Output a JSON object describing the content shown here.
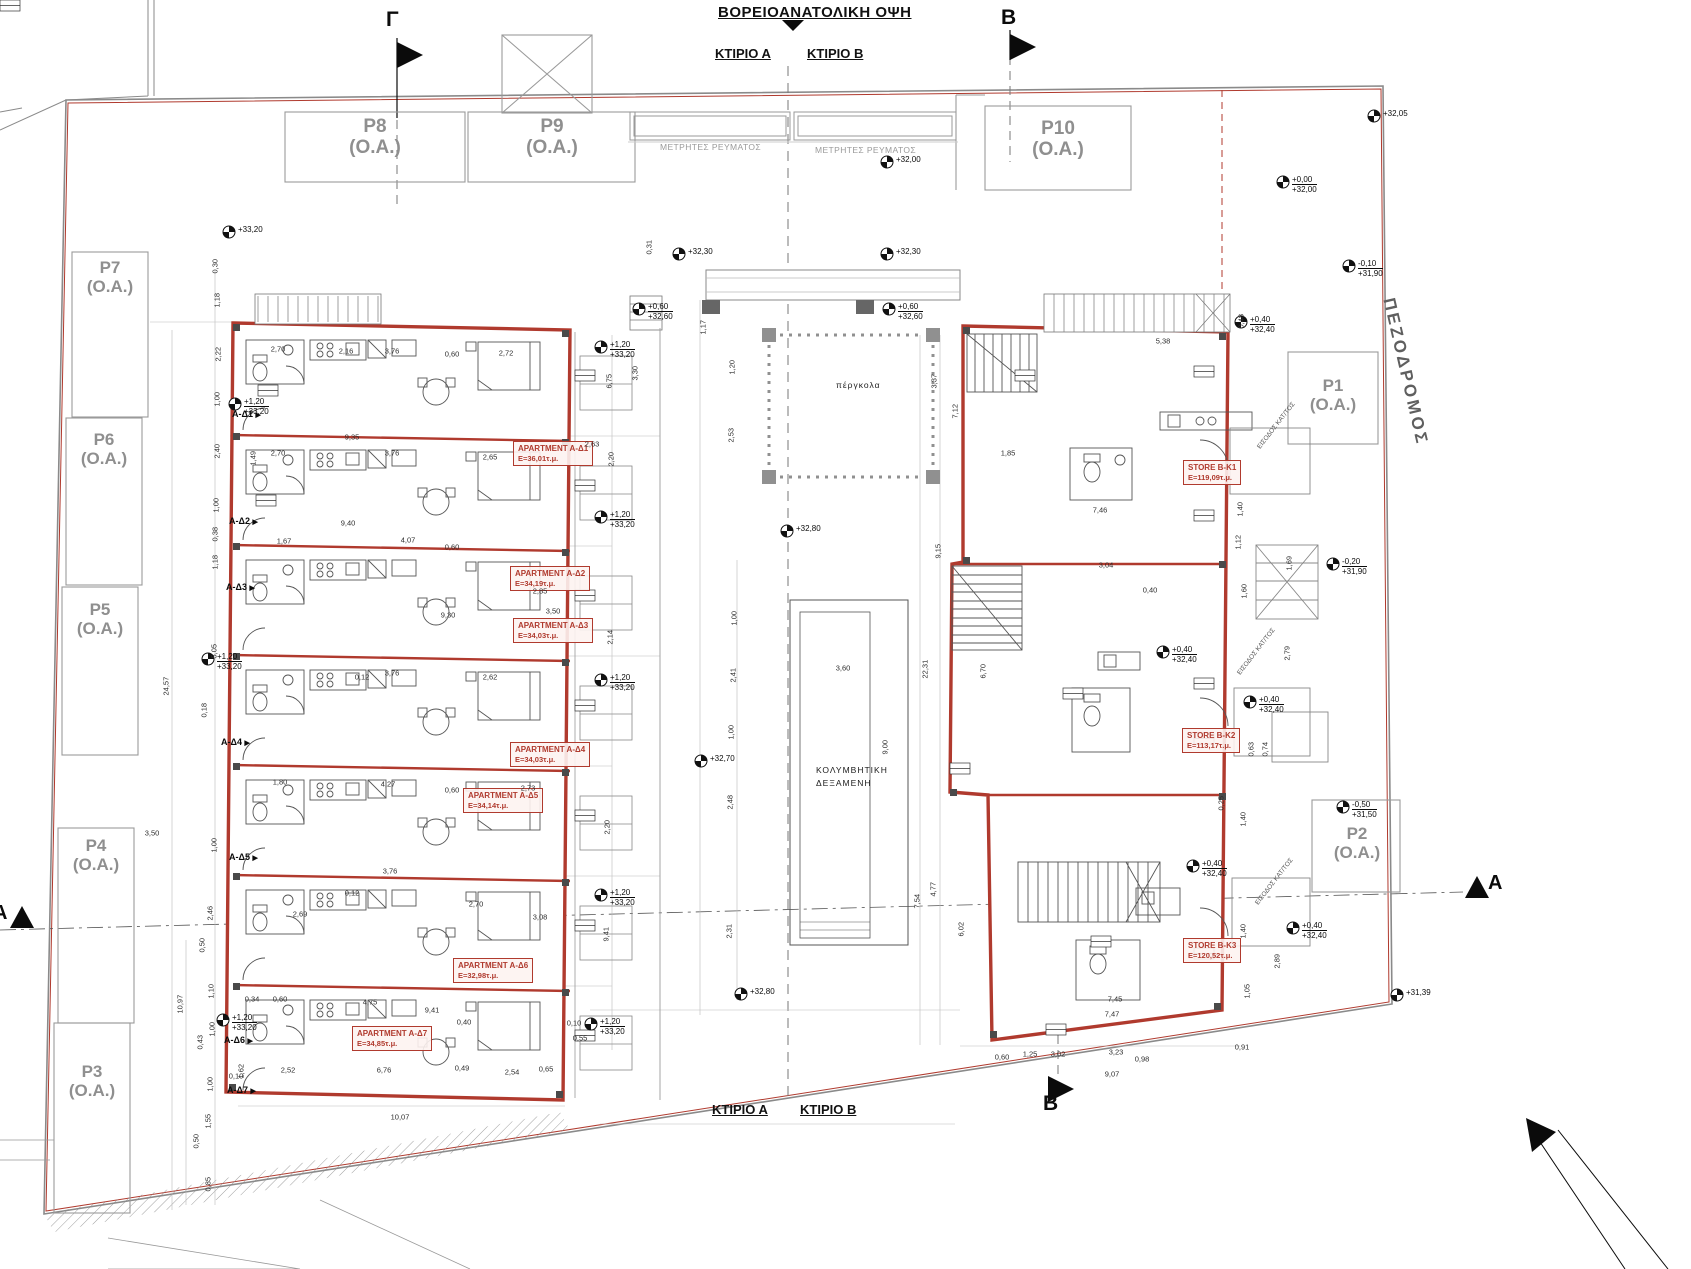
{
  "header": {
    "view_title": "ΒΟΡΕΙΟΑΝΑΤΟΛΙΚΗ ΟΨΗ",
    "building_a": "ΚΤΙΡΙΟ Α",
    "building_b": "ΚΤΙΡΙΟ Β"
  },
  "footer": {
    "building_a": "ΚΤΙΡΙΟ Α",
    "building_b": "ΚΤΙΡΙΟ Β"
  },
  "street": {
    "name": "ΠΕΖΟΔΡΟΜΟΣ"
  },
  "pergola": {
    "label": "πέργκολα"
  },
  "pool": {
    "line1": "ΚΟΛΥΜΒΗΤΙΚΗ",
    "line2": "ΔΕΞΑΜΕΝΗ"
  },
  "meters": {
    "label": "ΜΕΤΡΗΤΕΣ ΡΕΥΜΑΤΟΣ"
  },
  "colors": {
    "accent_red": "#b03a2e",
    "line_dark": "#3a3a3a",
    "line_light": "#999999",
    "text_gray": "#8f8f8f"
  },
  "section_markers": [
    {
      "label": "Γ",
      "x": 386,
      "y": 8,
      "size": 21
    },
    {
      "label": "Β",
      "x": 1001,
      "y": 6,
      "size": 21
    },
    {
      "label": "Β",
      "x": 1043,
      "y": 1092,
      "size": 21
    },
    {
      "label": "Α",
      "x": 1488,
      "y": 872,
      "size": 20
    },
    {
      "label": "Α",
      "x": -7,
      "y": 902,
      "size": 20
    }
  ],
  "parking": [
    {
      "id": "P8",
      "sub": "(Ο.Α.)",
      "x": 375,
      "y": 116,
      "fs": 19
    },
    {
      "id": "P9",
      "sub": "(Ο.Α.)",
      "x": 552,
      "y": 116,
      "fs": 19
    },
    {
      "id": "P10",
      "sub": "(Ο.Α.)",
      "x": 1058,
      "y": 118,
      "fs": 19
    },
    {
      "id": "P7",
      "sub": "(Ο.Α.)",
      "x": 110,
      "y": 258,
      "fs": 17
    },
    {
      "id": "P6",
      "sub": "(Ο.Α.)",
      "x": 104,
      "y": 430,
      "fs": 17
    },
    {
      "id": "P5",
      "sub": "(Ο.Α.)",
      "x": 100,
      "y": 600,
      "fs": 17
    },
    {
      "id": "P4",
      "sub": "(Ο.Α.)",
      "x": 96,
      "y": 836,
      "fs": 17
    },
    {
      "id": "P3",
      "sub": "(Ο.Α.)",
      "x": 92,
      "y": 1062,
      "fs": 17
    },
    {
      "id": "P1",
      "sub": "(Ο.Α.)",
      "x": 1333,
      "y": 376,
      "fs": 17
    },
    {
      "id": "P2",
      "sub": "(Ο.Α.)",
      "x": 1357,
      "y": 824,
      "fs": 17
    }
  ],
  "apartments": [
    {
      "name": "APARTMENT A-Δ1",
      "area": "E=36,01τ.μ.",
      "x": 513,
      "y": 441
    },
    {
      "name": "APARTMENT A-Δ2",
      "area": "E=34,19τ.μ.",
      "x": 510,
      "y": 566
    },
    {
      "name": "APARTMENT A-Δ3",
      "area": "E=34,03τ.μ.",
      "x": 513,
      "y": 618
    },
    {
      "name": "APARTMENT A-Δ4",
      "area": "E=34,03τ.μ.",
      "x": 510,
      "y": 742
    },
    {
      "name": "APARTMENT A-Δ5",
      "area": "E=34,14τ.μ.",
      "x": 463,
      "y": 788
    },
    {
      "name": "APARTMENT A-Δ6",
      "area": "E=32,98τ.μ.",
      "x": 453,
      "y": 958
    },
    {
      "name": "APARTMENT A-Δ7",
      "area": "E=34,85τ.μ.",
      "x": 352,
      "y": 1026
    }
  ],
  "stores": [
    {
      "name": "STORE  B-K1",
      "area": "E=119,09τ.μ.",
      "x": 1183,
      "y": 460
    },
    {
      "name": "STORE  B-K2",
      "area": "E=113,17τ.μ.",
      "x": 1182,
      "y": 728
    },
    {
      "name": "STORE  B-K3",
      "area": "E=120,52τ.μ.",
      "x": 1183,
      "y": 938
    }
  ],
  "unit_tags": [
    {
      "label": "Α-Δ1",
      "x": 232,
      "y": 409
    },
    {
      "label": "Α-Δ2",
      "x": 229,
      "y": 516
    },
    {
      "label": "Α-Δ3",
      "x": 226,
      "y": 582
    },
    {
      "label": "Α-Δ4",
      "x": 221,
      "y": 737
    },
    {
      "label": "Α-Δ5",
      "x": 229,
      "y": 852
    },
    {
      "label": "Α-Δ6",
      "x": 224,
      "y": 1035
    },
    {
      "label": "Α-Δ7",
      "x": 227,
      "y": 1085
    }
  ],
  "entrance_labels": [
    {
      "text": "ΕΙΣΟΔΟΣ ΚΑΤ/ΤΟΣ",
      "x": 1256,
      "y": 446,
      "r": -52
    },
    {
      "text": "ΕΙΣΟΔΟΣ ΚΑΤ/ΤΟΣ",
      "x": 1236,
      "y": 672,
      "r": -52
    },
    {
      "text": "ΕΙΣΟΔΟΣ ΚΑΤ/ΤΟΣ",
      "x": 1254,
      "y": 902,
      "r": -52
    }
  ],
  "elevations": [
    {
      "lines": [
        "+32,05"
      ],
      "x": 1385,
      "y": 112
    },
    {
      "lines": [
        "+32,00"
      ],
      "x": 898,
      "y": 158
    },
    {
      "lines": [
        "+0,00",
        "+32,00"
      ],
      "x": 1294,
      "y": 178
    },
    {
      "lines": [
        "+32,30"
      ],
      "x": 690,
      "y": 250
    },
    {
      "lines": [
        "+32,30"
      ],
      "x": 898,
      "y": 250
    },
    {
      "lines": [
        "-0,10",
        "+31,90"
      ],
      "x": 1360,
      "y": 262
    },
    {
      "lines": [
        "+0,60",
        "+32,60"
      ],
      "x": 650,
      "y": 305
    },
    {
      "lines": [
        "+0,60",
        "+32,60"
      ],
      "x": 900,
      "y": 305
    },
    {
      "lines": [
        "+0,40",
        "+32,40"
      ],
      "x": 1252,
      "y": 318
    },
    {
      "lines": [
        "+33,20"
      ],
      "x": 240,
      "y": 228
    },
    {
      "lines": [
        "+1,20",
        "+33,20"
      ],
      "x": 246,
      "y": 400
    },
    {
      "lines": [
        "+1,20",
        "+33,20"
      ],
      "x": 612,
      "y": 343
    },
    {
      "lines": [
        "+1,20",
        "+33,20"
      ],
      "x": 612,
      "y": 513
    },
    {
      "lines": [
        "+32,80"
      ],
      "x": 798,
      "y": 527
    },
    {
      "lines": [
        "-0,20",
        "+31,90"
      ],
      "x": 1344,
      "y": 560
    },
    {
      "lines": [
        "+1,20",
        "+33,20"
      ],
      "x": 219,
      "y": 655
    },
    {
      "lines": [
        "+1,20",
        "+33,20"
      ],
      "x": 612,
      "y": 676
    },
    {
      "lines": [
        "+0,40",
        "+32,40"
      ],
      "x": 1174,
      "y": 648
    },
    {
      "lines": [
        "+0,40",
        "+32,40"
      ],
      "x": 1261,
      "y": 698
    },
    {
      "lines": [
        "+32,70"
      ],
      "x": 712,
      "y": 757
    },
    {
      "lines": [
        "-0,50",
        "+31,50"
      ],
      "x": 1354,
      "y": 803
    },
    {
      "lines": [
        "+0,40",
        "+32,40"
      ],
      "x": 1204,
      "y": 862
    },
    {
      "lines": [
        "+1,20",
        "+33,20"
      ],
      "x": 612,
      "y": 891
    },
    {
      "lines": [
        "+0,40",
        "+32,40"
      ],
      "x": 1304,
      "y": 924
    },
    {
      "lines": [
        "+1,20",
        "+33,20"
      ],
      "x": 234,
      "y": 1016
    },
    {
      "lines": [
        "+32,80"
      ],
      "x": 752,
      "y": 990
    },
    {
      "lines": [
        "+31,39"
      ],
      "x": 1408,
      "y": 991
    },
    {
      "lines": [
        "+1,20",
        "+33,20"
      ],
      "x": 602,
      "y": 1020
    }
  ],
  "dimensions": [
    [
      "0,30",
      218,
      278,
      -90
    ],
    [
      "1,18",
      220,
      312,
      -90
    ],
    [
      "2,22",
      221,
      366,
      -90
    ],
    [
      "1,00",
      220,
      411,
      -90
    ],
    [
      "2,40",
      220,
      463,
      -90
    ],
    [
      "1,00",
      219,
      517,
      -90
    ],
    [
      "0,38",
      218,
      546,
      -90
    ],
    [
      "1,18",
      218,
      574,
      -90
    ],
    [
      "5,05",
      217,
      663,
      -90
    ],
    [
      "24,57",
      171,
      700,
      -90
    ],
    [
      "0,18",
      207,
      722,
      -90
    ],
    [
      "3,50",
      152,
      833,
      0
    ],
    [
      "1,00",
      217,
      857,
      -90
    ],
    [
      "2,46",
      213,
      925,
      -90
    ],
    [
      "0,50",
      205,
      957,
      -90
    ],
    [
      "1,10",
      214,
      1003,
      -90
    ],
    [
      "10,97",
      185,
      1018,
      -90
    ],
    [
      "1,00",
      215,
      1041,
      -90
    ],
    [
      "0,43",
      203,
      1054,
      -90
    ],
    [
      "0,10",
      236,
      1076,
      0
    ],
    [
      "1,00",
      213,
      1096,
      -90
    ],
    [
      "1,55",
      211,
      1133,
      -90
    ],
    [
      "0,50",
      199,
      1153,
      -90
    ],
    [
      "0,85",
      211,
      1196,
      -90
    ],
    [
      "2,70",
      278,
      349,
      0
    ],
    [
      "2,16",
      346,
      351,
      0
    ],
    [
      "3,76",
      392,
      351,
      0
    ],
    [
      "0,60",
      452,
      354,
      0
    ],
    [
      "2,72",
      506,
      353,
      0
    ],
    [
      "9,35",
      352,
      437,
      0
    ],
    [
      "1,49",
      256,
      470,
      -90
    ],
    [
      "2,70",
      278,
      453,
      0
    ],
    [
      "3,76",
      392,
      453,
      0
    ],
    [
      "2,65",
      490,
      457,
      0
    ],
    [
      "9,40",
      348,
      523,
      0
    ],
    [
      "1,67",
      284,
      541,
      0
    ],
    [
      "4,07",
      408,
      540,
      0
    ],
    [
      "0,60",
      452,
      547,
      0
    ],
    [
      "2,85",
      540,
      591,
      0
    ],
    [
      "9,30",
      448,
      615,
      0
    ],
    [
      "3,50",
      553,
      611,
      0
    ],
    [
      "2,63",
      592,
      444,
      0
    ],
    [
      "0,12",
      362,
      677,
      0
    ],
    [
      "3,76",
      392,
      673,
      0
    ],
    [
      "2,62",
      490,
      677,
      0
    ],
    [
      "1,80",
      280,
      782,
      0
    ],
    [
      "4,27",
      388,
      784,
      0
    ],
    [
      "2,73",
      528,
      788,
      0
    ],
    [
      "0,60",
      452,
      790,
      0
    ],
    [
      "3,76",
      390,
      871,
      0
    ],
    [
      "0,12",
      352,
      893,
      0
    ],
    [
      "2,69",
      300,
      914,
      0
    ],
    [
      "2,70",
      476,
      904,
      0
    ],
    [
      "3,08",
      540,
      917,
      0
    ],
    [
      "0,34",
      252,
      999,
      0
    ],
    [
      "0,60",
      280,
      999,
      0
    ],
    [
      "4,75",
      370,
      1002,
      0
    ],
    [
      "9,41",
      432,
      1010,
      0
    ],
    [
      "0,40",
      464,
      1022,
      0
    ],
    [
      "2,52",
      288,
      1070,
      0
    ],
    [
      "6,76",
      384,
      1070,
      0
    ],
    [
      "0,49",
      462,
      1068,
      0
    ],
    [
      "2,54",
      512,
      1072,
      0
    ],
    [
      "1,62",
      244,
      1083,
      -90
    ],
    [
      "10,07",
      400,
      1117,
      0
    ],
    [
      "0,65",
      546,
      1069,
      0
    ],
    [
      "0,10",
      574,
      1023,
      0
    ],
    [
      "0,55",
      580,
      1038,
      0
    ],
    [
      "0,31",
      652,
      259,
      -90
    ],
    [
      "3,30",
      638,
      385,
      -90
    ],
    [
      "6,75",
      612,
      393,
      -90
    ],
    [
      "2,20",
      614,
      471,
      -90
    ],
    [
      "2,14",
      613,
      649,
      -90
    ],
    [
      "2,20",
      610,
      839,
      -90
    ],
    [
      "9,41",
      609,
      946,
      -90
    ],
    [
      "1,17",
      706,
      339,
      -90
    ],
    [
      "1,20",
      735,
      379,
      -90
    ],
    [
      "2,53",
      734,
      447,
      -90
    ],
    [
      "1,00",
      737,
      630,
      -90
    ],
    [
      "2,41",
      736,
      687,
      -90
    ],
    [
      "1,00",
      734,
      744,
      -90
    ],
    [
      "2,48",
      733,
      814,
      -90
    ],
    [
      "2,31",
      732,
      943,
      -90
    ],
    [
      "3,60",
      843,
      668,
      0
    ],
    [
      "9,00",
      888,
      759,
      -90
    ],
    [
      "5,38",
      1163,
      341,
      0
    ],
    [
      "3,37",
      937,
      393,
      -90
    ],
    [
      "7,12",
      958,
      423,
      -90
    ],
    [
      "9,15",
      941,
      563,
      -90
    ],
    [
      "1,85",
      1008,
      453,
      0
    ],
    [
      "7,46",
      1100,
      510,
      0
    ],
    [
      "3,04",
      1106,
      565,
      0
    ],
    [
      "0,40",
      1150,
      590,
      0
    ],
    [
      "22,31",
      930,
      683,
      -90
    ],
    [
      "6,70",
      986,
      683,
      -90
    ],
    [
      "7,54",
      920,
      913,
      -90
    ],
    [
      "4,77",
      936,
      901,
      -90
    ],
    [
      "6,02",
      964,
      941,
      -90
    ],
    [
      "7,45",
      1115,
      999,
      0
    ],
    [
      "7,47",
      1112,
      1014,
      0
    ],
    [
      "3,23",
      1116,
      1052,
      0
    ],
    [
      "3,02",
      1058,
      1054,
      0
    ],
    [
      "0,98",
      1142,
      1059,
      0
    ],
    [
      "9,07",
      1112,
      1074,
      0
    ],
    [
      "0,91",
      1242,
      1047,
      0
    ],
    [
      "2,89",
      1280,
      973,
      -90
    ],
    [
      "0,60",
      1002,
      1057,
      0
    ],
    [
      "1,25",
      1030,
      1054,
      0
    ],
    [
      "1,40",
      1243,
      521,
      -90
    ],
    [
      "1,12",
      1241,
      554,
      -90
    ],
    [
      "1,60",
      1247,
      603,
      -90
    ],
    [
      "1,69",
      1292,
      575,
      -90
    ],
    [
      "2,79",
      1290,
      665,
      -90
    ],
    [
      "0,63",
      1254,
      761,
      -90
    ],
    [
      "0,74",
      1268,
      761,
      -90
    ],
    [
      "0,25",
      1224,
      815,
      -90
    ],
    [
      "1,40",
      1246,
      831,
      -90
    ],
    [
      "1,40",
      1246,
      943,
      -90
    ],
    [
      "1,05",
      1250,
      1003,
      -90
    ],
    [
      "0,48",
      1244,
      333,
      -90
    ]
  ]
}
